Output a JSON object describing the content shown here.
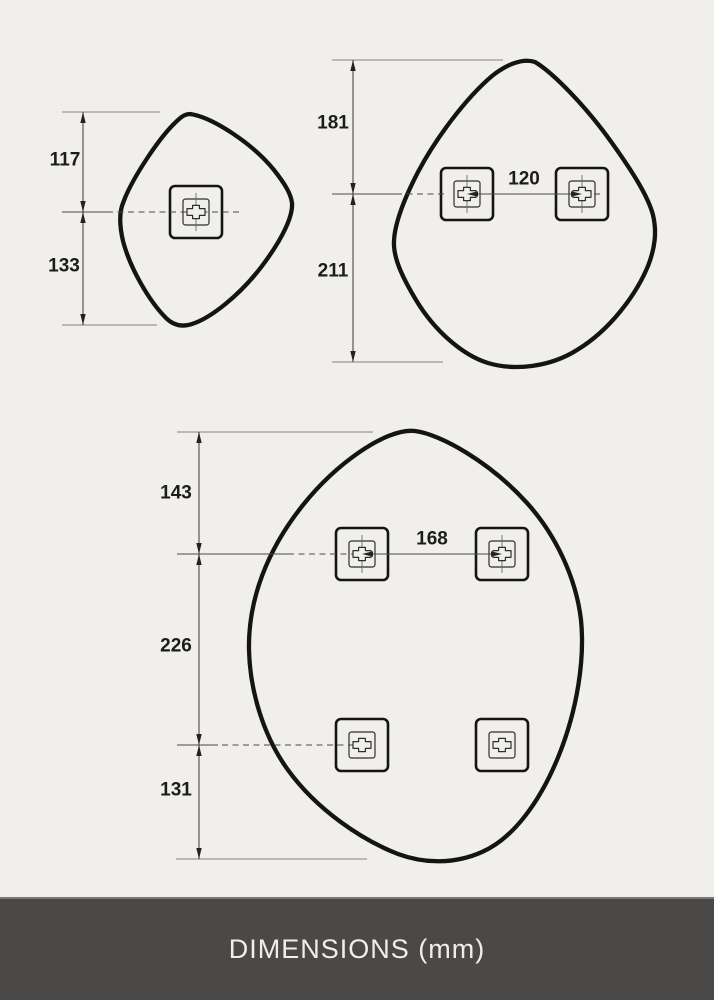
{
  "footer": {
    "title": "DIMENSIONS (mm)"
  },
  "colors": {
    "canvas_background": "#f1efec",
    "mirror_outline": "#141414",
    "dimension_lines": "#4a4a4a",
    "extension_lines": "#9b9997",
    "footer_background": "#4a4948",
    "footer_text": "#efeeec"
  },
  "mirrors": {
    "small": {
      "height_above_hole": "117",
      "height_below_hole": "133"
    },
    "medium": {
      "height_above_holes": "181",
      "height_below_holes": "211",
      "hole_spacing": "120"
    },
    "large": {
      "height_above_holes": "143",
      "height_between_rows": "226",
      "height_below_holes": "131",
      "hole_spacing": "168"
    }
  }
}
